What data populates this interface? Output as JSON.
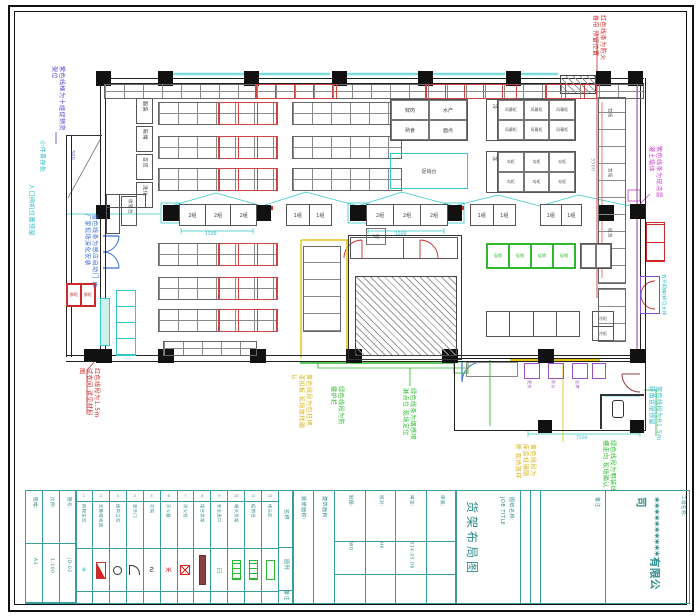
{
  "annotations": {
    "a1": {
      "text": "紫色线框为十组促销货架位"
    },
    "a2": {
      "text": "小件寄存处"
    },
    "a3": {
      "text": "入口闸机位置预留"
    },
    "a4": {
      "text": "蓝色线条为感应自动门 由厂家现场深化安装"
    },
    "a5": {
      "text": "红色线段为1.5m试衣间 详见材料图"
    },
    "a6": {
      "text": "黄色线段为包柱烤漆扣板 现场放样确认"
    },
    "a7": {
      "text": "绿色线段为防撞护栏"
    },
    "a8": {
      "text": "绿色线条为烟感喷淋点位 现场定位"
    },
    "a9": {
      "text": "黄色线段为库房轻钢隔断 现场放样"
    },
    "a10": {
      "text": "绿色线段为明装线槽走向 现场确认"
    },
    "a11": {
      "text": "红色线条为防火卷帘 预留位置"
    },
    "a12": {
      "text": "紫色线条为现浇混凝土墙体"
    },
    "a13": {
      "text": "蓝色线段为R1.5m转角货架预留"
    },
    "a14": {
      "text": "双开门斗 详见大样"
    }
  },
  "plan": {
    "racks": [
      "服装",
      "鞋帽",
      "百货",
      "洗化"
    ],
    "checkout": {
      "counter": "收银台",
      "c1": [
        "2组",
        "2组",
        "2组"
      ],
      "c2": [
        "2组",
        "2组",
        "2组"
      ],
      "p1": [
        "1组",
        "1组"
      ],
      "p2": [
        "1组",
        "1组"
      ],
      "p3": [
        "1组",
        "1组"
      ],
      "note": "3组"
    },
    "tableA": [
      "鲜肉",
      "水产",
      "熟食",
      "面点"
    ],
    "tableB": {
      "head": "冷",
      "cells": [
        "风幕柜",
        "风幕柜",
        "风幕柜",
        "风幕柜",
        "风幕柜",
        "风幕柜"
      ]
    },
    "tableC": {
      "head": "冻",
      "cells": [
        "岛柜",
        "岛柜",
        "岛柜",
        "岛柜",
        "岛柜",
        "岛柜"
      ]
    },
    "island": "促销台",
    "greenTable": [
      "促销",
      "促销",
      "促销",
      "促销"
    ],
    "counterSegs": [
      "背柜",
      "背柜",
      "收货"
    ],
    "fridgePair": [
      "冷柜",
      "冷柜"
    ],
    "redCells": [
      "鲜柜",
      "鲜柜"
    ],
    "annexRooms": [
      "更衣",
      "办公",
      "仓库"
    ],
    "dims": {
      "d1": "1500",
      "d2": "1500",
      "d3": "300",
      "d4": "4500",
      "d5": "7500",
      "d6": "3500"
    }
  },
  "legend": {
    "headers": {
      "name": "名称",
      "symbol": "图例",
      "note": "备注"
    },
    "items": [
      {
        "no": "1",
        "name": "购物车位"
      },
      {
        "no": "2",
        "name": "无障碍坡道"
      },
      {
        "no": "3",
        "name": "结构立柱"
      },
      {
        "no": "4",
        "name": "单开门"
      },
      {
        "no": "5",
        "name": "衣钩"
      },
      {
        "no": "6",
        "name": "灭火器"
      },
      {
        "no": "7",
        "name": "消火栓"
      },
      {
        "no": "8",
        "name": "组合货架"
      },
      {
        "no": "9",
        "name": "安全出口"
      },
      {
        "no": "10",
        "name": "端头货架"
      },
      {
        "no": "11",
        "name": "促销台"
      },
      {
        "no": "12",
        "name": "堆头区"
      }
    ],
    "mini": [
      {
        "label": "图幅:",
        "value": "A3"
      },
      {
        "label": "比例:",
        "value": "1:100"
      },
      {
        "label": "图号:",
        "value": "JD-02"
      }
    ]
  },
  "titleblock": {
    "area1": "装修面积:",
    "area2": "建筑面积:",
    "fields": [
      {
        "label": "制图:",
        "value": "DWG"
      },
      {
        "label": "校对:",
        "value": "CHK"
      },
      {
        "label": "审定:",
        "value": "2014.05.06"
      },
      {
        "label": "审核:",
        "value": ""
      }
    ],
    "job_label": "图纸名称:",
    "job_sub": "JOB TITLE",
    "job_title": "货架布局图",
    "note_label": "备注:",
    "project_label": "工程名称:",
    "company": "**********有限公司"
  },
  "colors": {
    "cyan": "#35c8c8",
    "red": "#cc2a2a",
    "green": "#2db82d",
    "yellow": "#e6c219",
    "magenta": "#c63ec6",
    "purple": "#5a3fd0",
    "teal": "#3a9d9d",
    "maroon": "#8a4040"
  }
}
